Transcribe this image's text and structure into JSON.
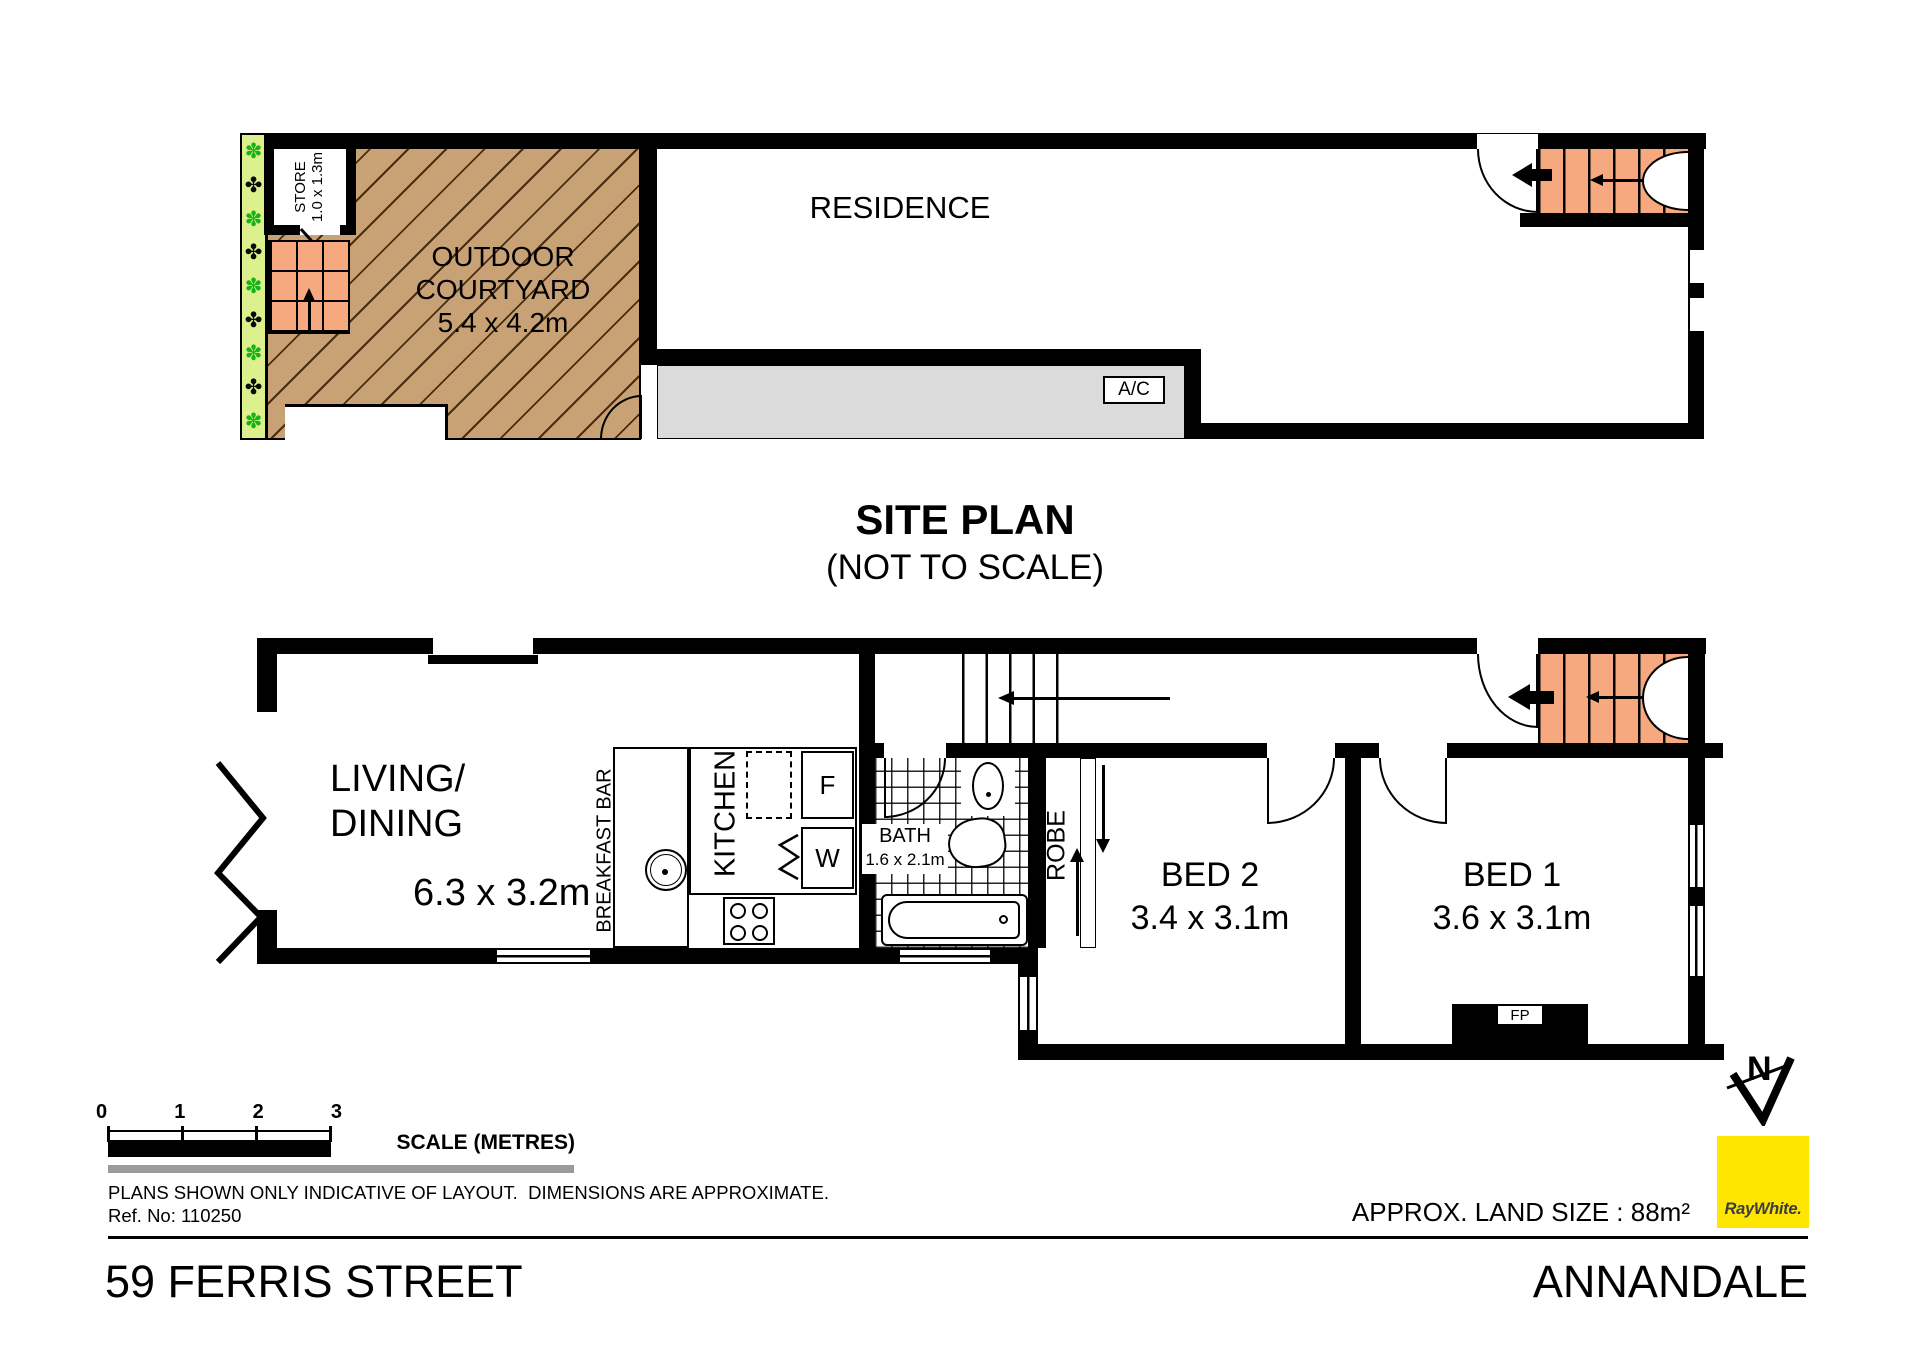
{
  "colors": {
    "wall": "#000000",
    "courtyard_fill": "#C8A175",
    "stair_fill": "#F6A97F",
    "garden_fill": "#DDF08E",
    "walkway_fill": "#DBDBDB",
    "brand_yellow": "#FFE600"
  },
  "site_plan": {
    "title": "SITE PLAN",
    "subtitle": "(NOT TO SCALE)",
    "residence_label": "RESIDENCE",
    "courtyard_line1": "OUTDOOR",
    "courtyard_line2": "COURTYARD",
    "courtyard_dims": "5.4 x 4.2m",
    "store_label": "STORE",
    "store_dims": "1.0 x 1.3m",
    "ac_label": "A/C",
    "garden_plants": [
      "✽",
      "✤",
      "✽",
      "✤",
      "✽",
      "✤",
      "✽",
      "✤",
      "✽"
    ]
  },
  "floor_plan": {
    "living_line1": "LIVING/",
    "living_line2": "DINING",
    "living_dims": "6.3 x 3.2m",
    "breakfast_bar_label": "BREAKFAST BAR",
    "kitchen_label": "KITCHEN",
    "fridge_label": "F",
    "washer_label": "W",
    "bath_label": "BATH",
    "bath_dims": "1.6 x 2.1m",
    "robe_label": "ROBE",
    "bed2_label": "BED 2",
    "bed2_dims": "3.4 x 3.1m",
    "bed1_label": "BED 1",
    "bed1_dims": "3.6 x 3.1m",
    "fireplace_label": "FP"
  },
  "scale_bar": {
    "ticks": [
      "0",
      "1",
      "2",
      "3"
    ],
    "label": "SCALE (METRES)"
  },
  "footer": {
    "disclaimer": "PLANS SHOWN ONLY INDICATIVE OF LAYOUT.  DIMENSIONS ARE APPROXIMATE.",
    "reference": "Ref. No: 110250",
    "land_size": "APPROX. LAND SIZE : 88m²",
    "street": "59 FERRIS STREET",
    "suburb": "ANNANDALE",
    "brand": "RayWhite.",
    "north_label": "N"
  }
}
